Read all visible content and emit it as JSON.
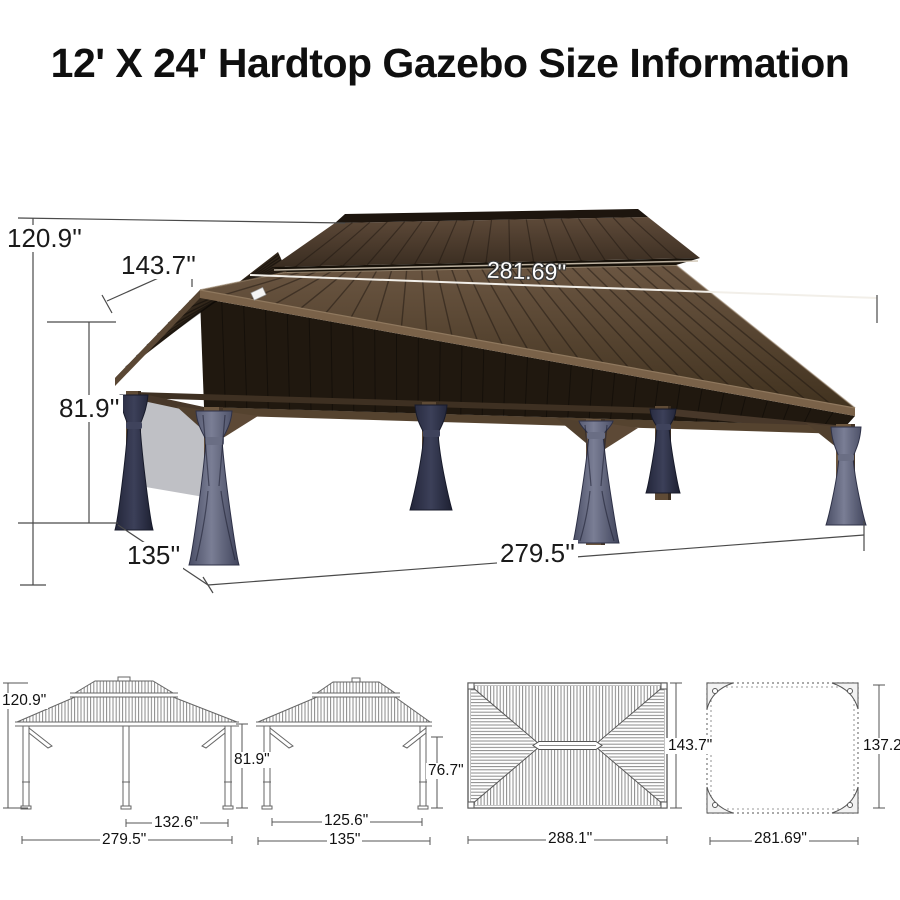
{
  "title": "12' X 24' Hardtop Gazebo Size Information",
  "main_figure": {
    "total_height": "120.9''",
    "roof_side_length": "143.7''",
    "roof_long_length": "281.69''",
    "post_height": "81.9''",
    "base_side_length": "135''",
    "base_long_length": "279.5''"
  },
  "diagrams": {
    "front_elevation": {
      "total_height": "120.9\"",
      "post_height": "81.9\"",
      "inner_span": "132.6\"",
      "total_width": "279.5\""
    },
    "side_elevation": {
      "post_height": "76.7\"",
      "inner_width": "125.6\"",
      "total_width": "135\""
    },
    "roof_plan": {
      "length": "288.1\"",
      "width": "143.7\""
    },
    "frame_plan": {
      "length": "281.69\"",
      "width": "137.2\""
    }
  },
  "colors": {
    "roof_brown": "#50402f",
    "roof_dark": "#2c2217",
    "fascia_brown": "#7a6249",
    "post_brown": "#6d573f",
    "curtain_grey_blue": "#5a5e74",
    "curtain_dark_navy": "#2e3247",
    "dimension_line": "#4a4a4a",
    "label_text": "#1a1a1a"
  }
}
